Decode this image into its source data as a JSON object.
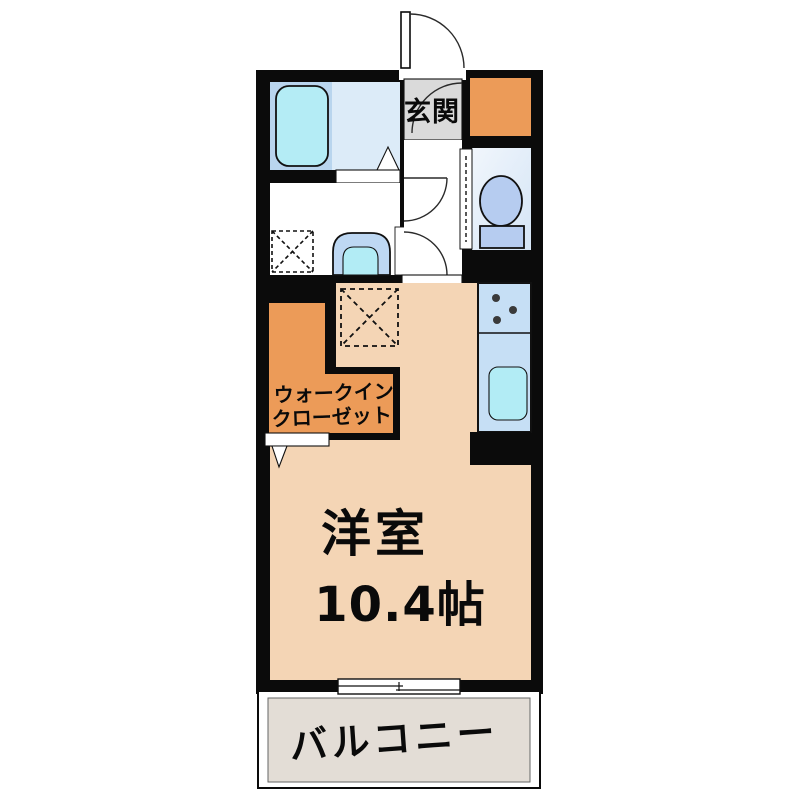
{
  "floor_plan": {
    "labels": {
      "entrance": "玄関",
      "closet_line1": "ウォークイン",
      "closet_line2": "クローゼット",
      "main_room_name": "洋室",
      "main_room_size": "10.4帖",
      "balcony": "バルコニー"
    },
    "palette": {
      "wall": "#0b0b0b",
      "main_room_floor": "#f4d5b5",
      "closet_fill": "#ec9b58",
      "storage_fill": "#ec9b58",
      "bath_zone": "#b9d5ee",
      "bath_floor": "#dcebf8",
      "tub_fill": "#b4ecf5",
      "basin_outer": "#bed8f3",
      "basin_inner": "#b2ecf5",
      "counter_fill": "#c6dff5",
      "sink_fill": "#b2ecf5",
      "toilet_fixture": "#b6ccf0",
      "entrance_floor": "#dadada",
      "balcony_floor": "#e3ddd6"
    }
  }
}
